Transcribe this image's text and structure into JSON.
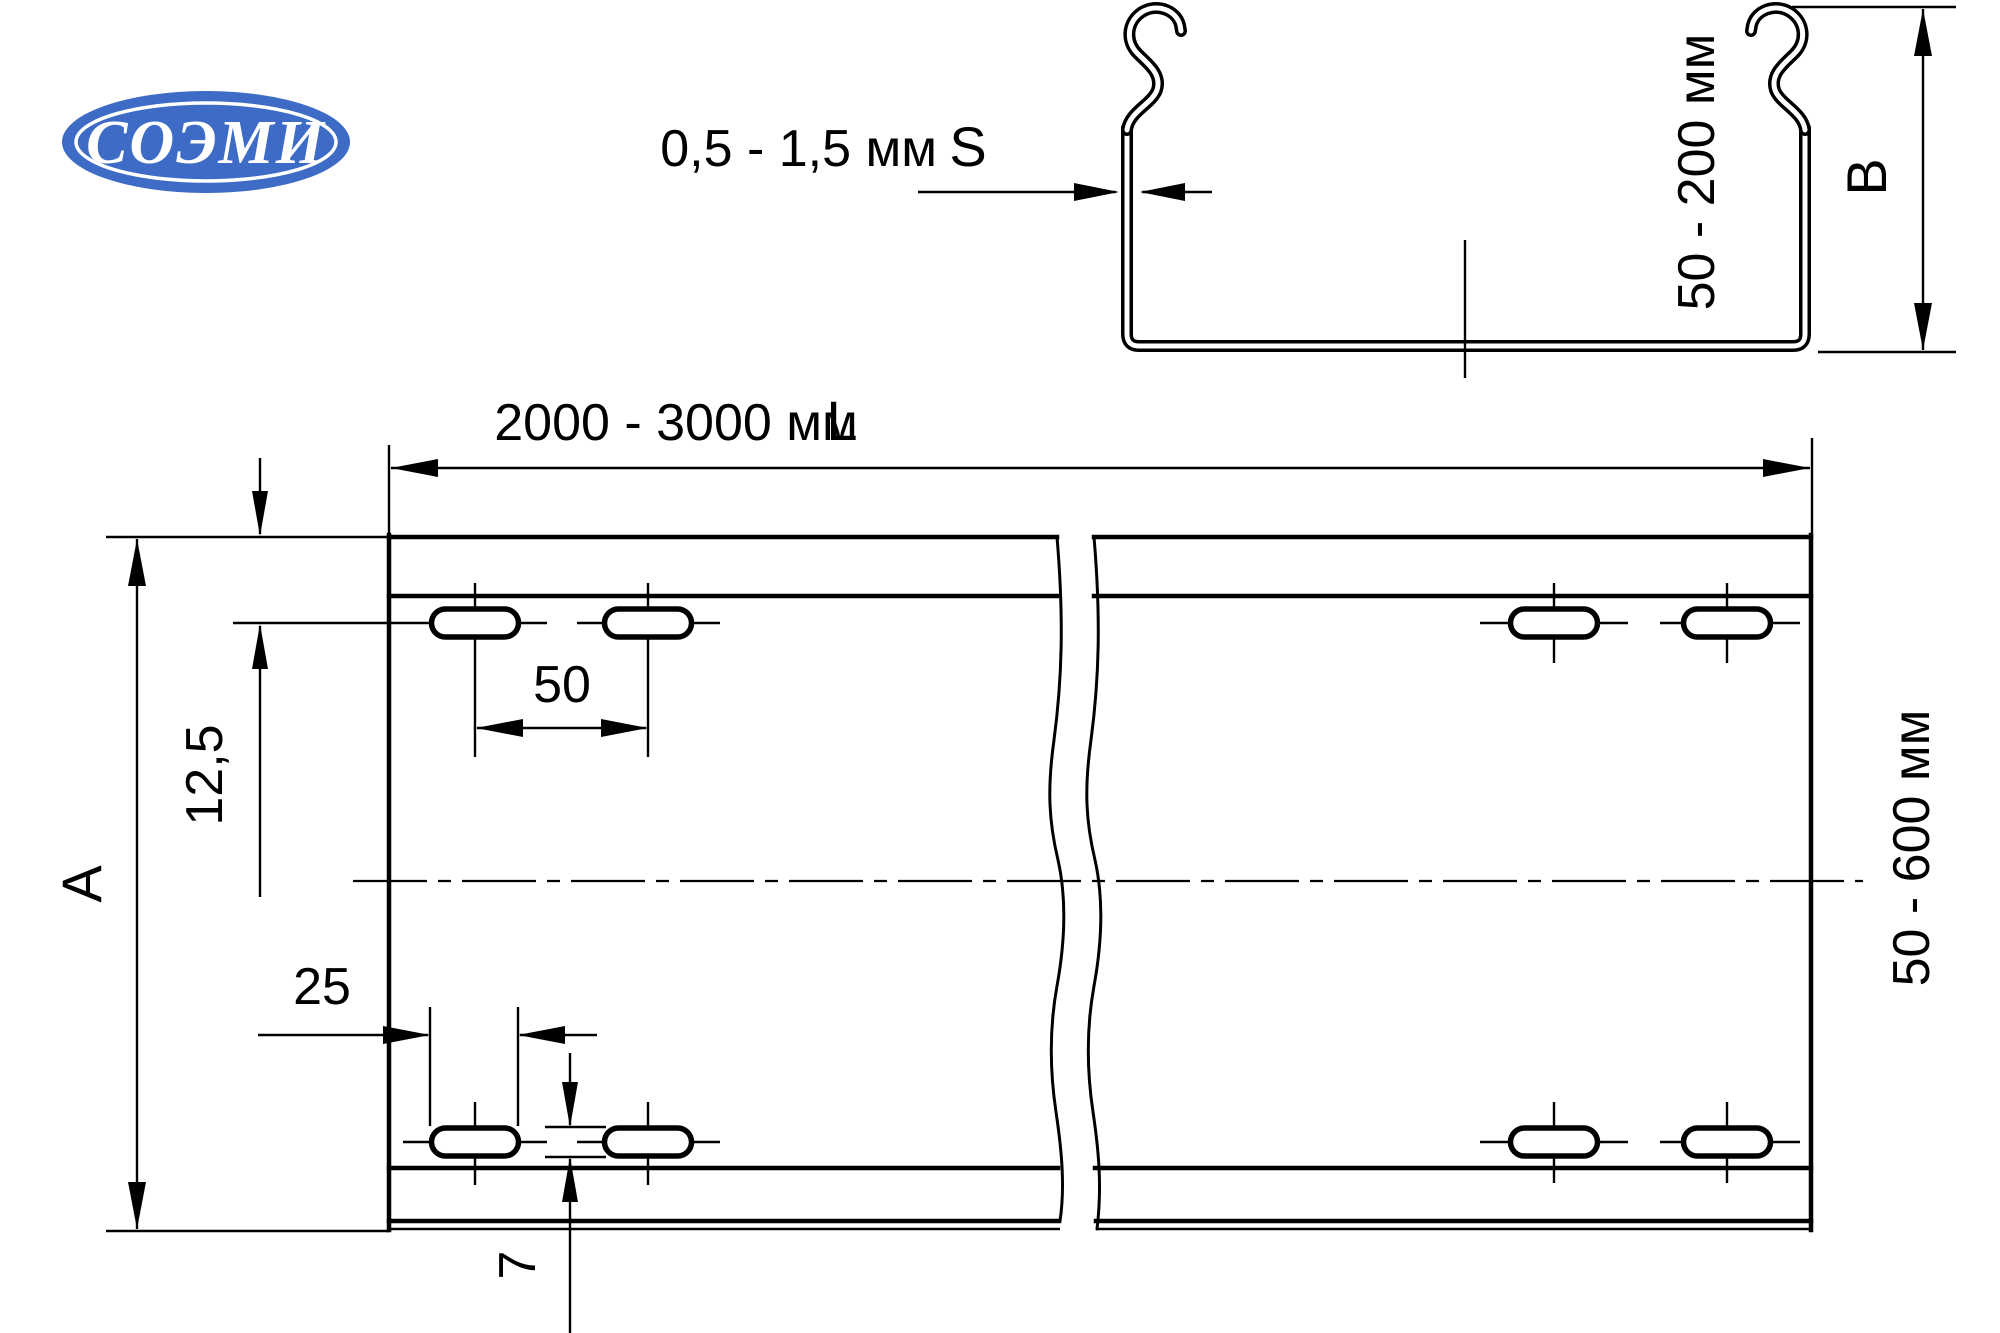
{
  "logo": {
    "text": "СОЭМИ"
  },
  "colors": {
    "ink": "#000000",
    "logo_blue": "#3d6bc6",
    "background": "#ffffff"
  },
  "section_view": {
    "thickness_value": "0,5 - 1,5 мм",
    "thickness_symbol": "S",
    "side_height_value": "50 - 200 мм",
    "side_height_symbol": "B"
  },
  "plan_view": {
    "length_value": "2000 - 3000 мм",
    "length_symbol": "L",
    "width_symbol": "A",
    "width_value": "50 - 600 мм",
    "slot_row_offset": "12,5",
    "slot_pitch": "50",
    "slot_length": "25",
    "slot_width": "7"
  }
}
